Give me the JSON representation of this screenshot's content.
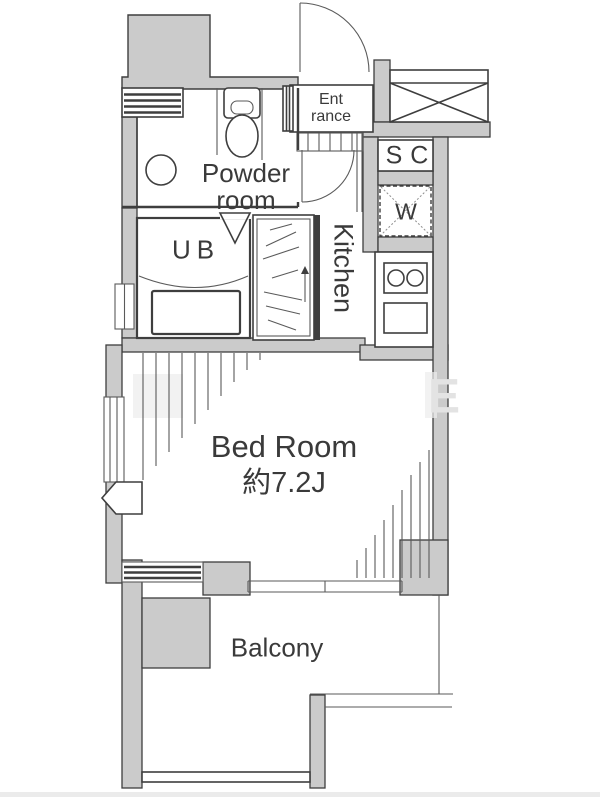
{
  "colors": {
    "wall_fill": "#cbcbcb",
    "line": "#3e3e3e",
    "thin_line": "#5a5a5a",
    "text": "#3a3a3a",
    "watermark": "#e3e3e3",
    "background": "#ffffff"
  },
  "rooms": {
    "entrance": {
      "lines": [
        "Ent",
        "rance"
      ]
    },
    "shoe_closet": {
      "label": "SC"
    },
    "washer": {
      "label": "W"
    },
    "kitchen": {
      "label": "Kitchen"
    },
    "powder_room": {
      "lines": [
        "Powder",
        "room"
      ]
    },
    "unit_bath": {
      "label": "UB"
    },
    "bedroom": {
      "name": "Bed Room",
      "size": "約7.2J"
    },
    "balcony": {
      "label": "Balcony"
    }
  },
  "watermark": {
    "letter": "E"
  }
}
